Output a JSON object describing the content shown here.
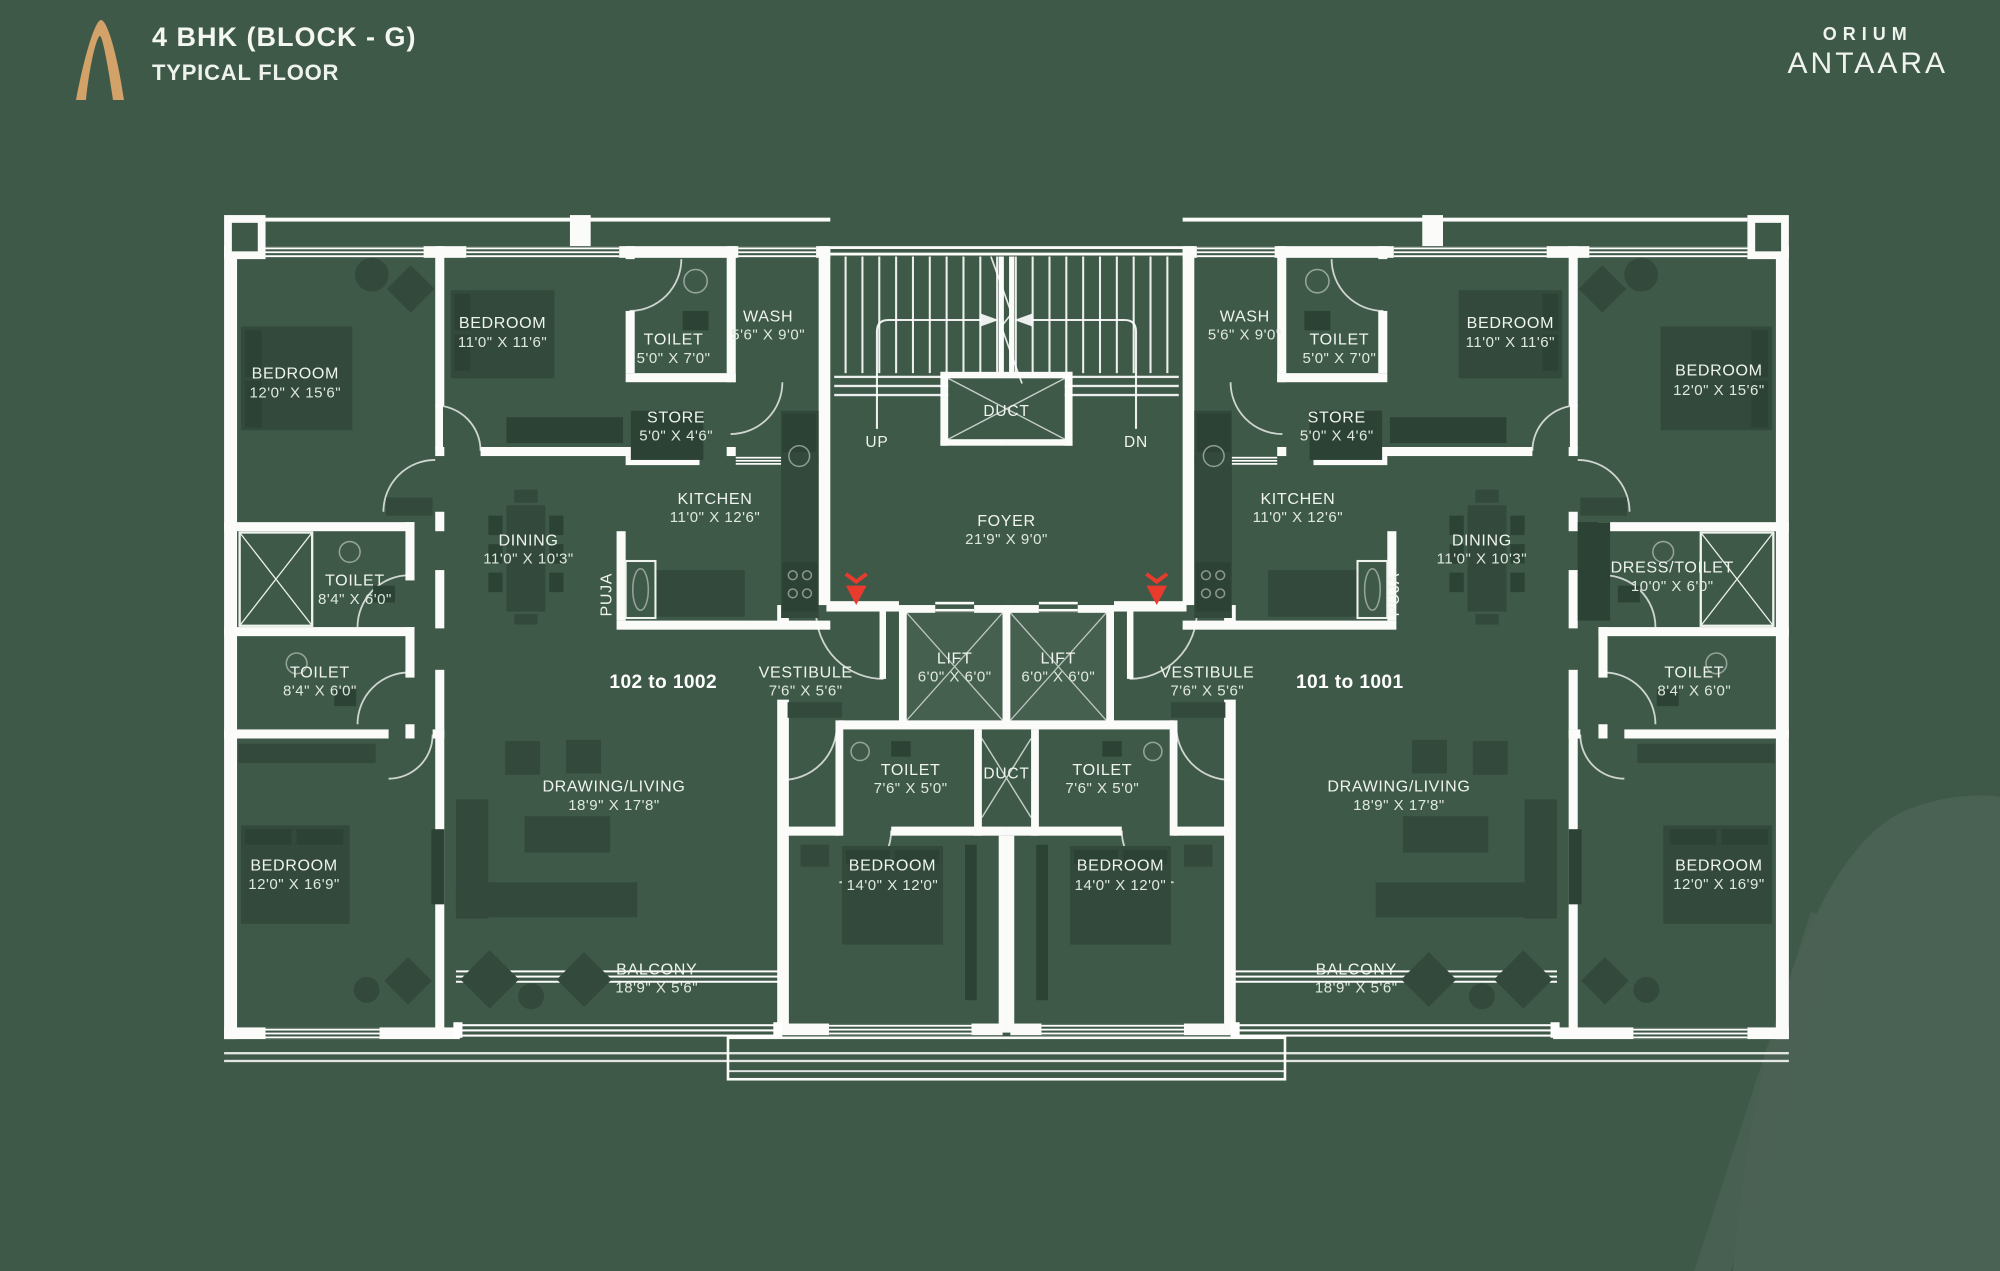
{
  "header": {
    "title": "4 BHK (BLOCK - G)",
    "subtitle": "TYPICAL FLOOR"
  },
  "brand": {
    "name": "ORIUM",
    "logotype": "ANTAARA"
  },
  "plan": {
    "units": {
      "left": "102 to 1002",
      "right": "101 to 1001"
    },
    "stairs": {
      "up": "UP",
      "down": "DN"
    },
    "rooms": {
      "bedroom_15": {
        "name": "BEDROOM",
        "dims": "12'0\" X 15'6\""
      },
      "bedroom_11": {
        "name": "BEDROOM",
        "dims": "11'0\" X 11'6\""
      },
      "toilet_5x7": {
        "name": "TOILET",
        "dims": "5'0\" X 7'0\""
      },
      "wash": {
        "name": "WASH",
        "dims": "5'6\" X 9'0\""
      },
      "store": {
        "name": "STORE",
        "dims": "5'0\" X 4'6\""
      },
      "kitchen": {
        "name": "KITCHEN",
        "dims": "11'0\" X 12'6\""
      },
      "dining": {
        "name": "DINING",
        "dims": "11'0\" X 10'3\""
      },
      "toilet_84": {
        "name": "TOILET",
        "dims": "8'4\" X 6'0\""
      },
      "puja": {
        "name": "PUJA"
      },
      "drawing_living": {
        "name": "DRAWING/LIVING",
        "dims": "18'9\" X 17'8\""
      },
      "bedroom_169": {
        "name": "BEDROOM",
        "dims": "12'0\" X 16'9\""
      },
      "balcony": {
        "name": "BALCONY",
        "dims": "18'9\" X 5'6\""
      },
      "bedroom_14": {
        "name": "BEDROOM",
        "dims": "14'0\" X 12'0\""
      },
      "toilet_76": {
        "name": "TOILET",
        "dims": "7'6\" X 5'0\""
      },
      "lift": {
        "name": "LIFT",
        "dims": "6'0\" X 6'0\""
      },
      "vestibule": {
        "name": "VESTIBULE",
        "dims": "7'6\" X 5'6\""
      },
      "duct": {
        "name": "DUCT"
      },
      "foyer": {
        "name": "FOYER",
        "dims": "21'9\" X 9'0\""
      },
      "dress_toilet": {
        "name": "DRESS/TOILET",
        "dims": "10'0\" X 6'0\""
      }
    }
  },
  "colors": {
    "background": "#3F5948",
    "walls": "#FBFCFA",
    "furniture": "#33493C",
    "accent_red": "#E93A2E",
    "logo_gold": "#D3A268",
    "label_text": "#EFF4EE"
  }
}
